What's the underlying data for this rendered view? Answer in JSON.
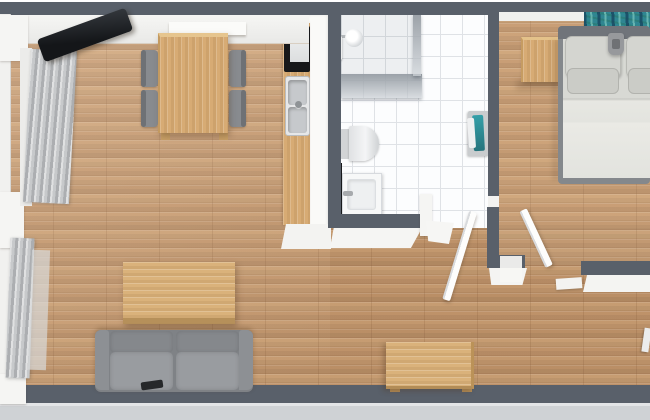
{
  "meta": {
    "view": "3D floor plan, top-down render",
    "description": "One-bedroom apartment: living/dining room, kitchenette, bathroom, bedroom and hallway",
    "width_px": 650,
    "height_px": 420
  },
  "palette": {
    "wall_top": "#59606a",
    "wall_face": "#f4f4f2",
    "exterior_ground": "#cfd2d5",
    "wood_floor": "#c89d73",
    "wood_furniture": "#d9b077",
    "bathroom_tile": "#fcfdfe",
    "tile_grout": "#dfe2e6",
    "sofa_gray": "#989b9f",
    "chair_gray": "#888b8f",
    "tv_black": "#1f2226",
    "towel_teal": "#2c8f99",
    "bed_linen": "#e2e3de",
    "headboard_gray": "#70747a",
    "glass_gray": "#9aa0a6"
  },
  "rooms": [
    {
      "id": "living-dining",
      "label": "Living / dining room (wood floor)"
    },
    {
      "id": "kitchen",
      "label": "Kitchenette counter strip"
    },
    {
      "id": "bathroom",
      "label": "Bathroom (white tile)"
    },
    {
      "id": "bedroom",
      "label": "Bedroom"
    },
    {
      "id": "hallway",
      "label": "Hallway"
    }
  ],
  "furniture": {
    "living": [
      "Flat-screen TV angled in top-left corner",
      "White wall radiator behind dining table",
      "Wood dining table",
      "Four gray dining chairs",
      "Wood coffee table",
      "Gray two-seat sofa",
      "Remote on sofa",
      "Window wall with gray curtains"
    ],
    "kitchen": [
      "Stove / oven",
      "Double-basin sink with faucet",
      "Wood countertop"
    ],
    "bathroom": [
      "Corner shower with glass panel",
      "Shower head",
      "Toilet",
      "Vanity sink with dark cabinet",
      "Towel rail with teal and white towels"
    ],
    "bedroom": [
      "Double bed with gray headboard",
      "Pillows",
      "Teal patterned wall art",
      "Wood nightstand",
      "Reading lamp"
    ],
    "hallway": [
      "Open white bathroom door",
      "Open white bedroom door",
      "Wood console table"
    ]
  }
}
